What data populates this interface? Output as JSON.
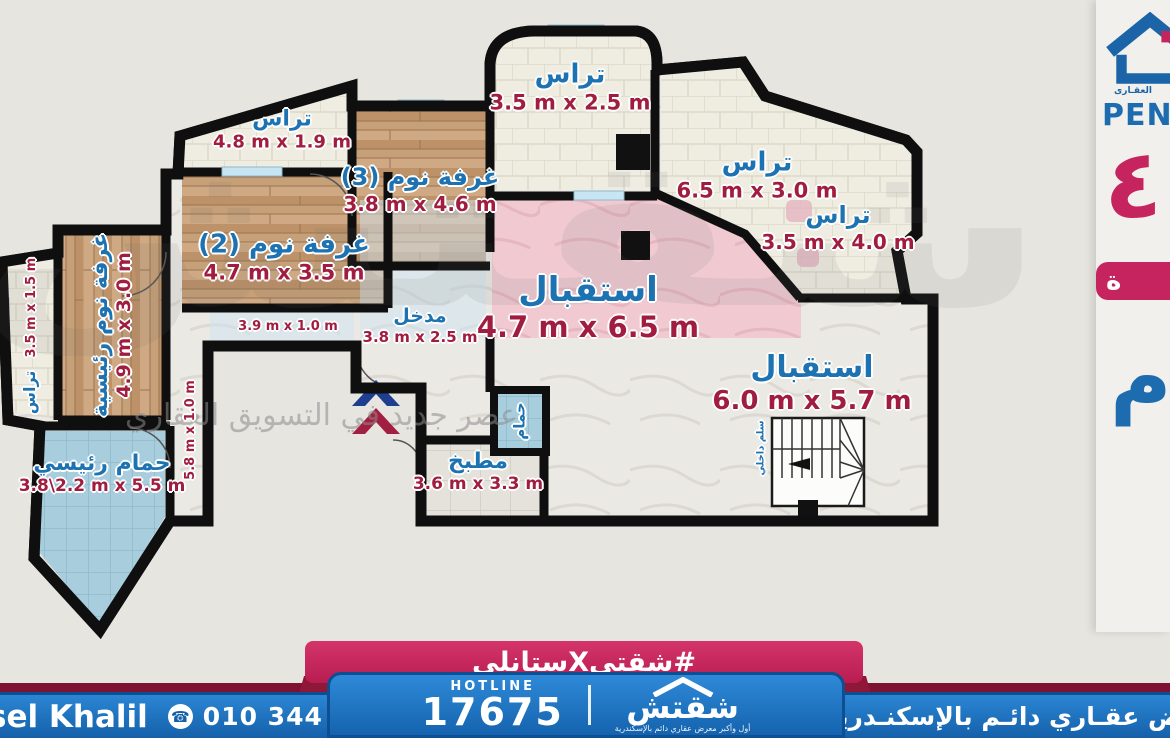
{
  "plan": {
    "terrace_top": {
      "label": "تراس",
      "dims": "3.5 m x 2.5 m"
    },
    "terrace_ne": {
      "label": "تراس",
      "dims": "6.5 m x 3.0 m"
    },
    "terrace_e": {
      "label": "تراس",
      "dims": "3.5 m x 4.0 m"
    },
    "terrace_nw": {
      "label": "تراس",
      "dims": "4.8 m x 1.9 m"
    },
    "terrace_w": {
      "label": "تراس",
      "dims": "3.5 m x 1.5 m"
    },
    "bedroom3": {
      "label": "غرفة نوم (3)",
      "dims": "3.8 m x 4.6 m"
    },
    "bedroom2": {
      "label": "غرفة نوم (2)",
      "dims": "4.7 m x 3.5 m"
    },
    "master_bedroom": {
      "label": "غرفة نوم رئيسية",
      "dims": "4.9 m x 3.0 m"
    },
    "reception_1": {
      "label": "استقبال",
      "dims": "4.7 m x 6.5 m"
    },
    "reception_2": {
      "label": "استقبال",
      "dims": "6.0 m x 5.7 m"
    },
    "entrance": {
      "label": "مدخل",
      "dims": "3.8 m x 2.5 m"
    },
    "bathroom": {
      "label": "حمام"
    },
    "kitchen": {
      "label": "مطبخ",
      "dims": "3.6 m x 3.3 m"
    },
    "master_bathroom": {
      "label": "حمام رئيسي",
      "dims": "3.8\\2.2 m x 5.5 m"
    },
    "corridor_top": {
      "dims": "3.9 m x 1.0 m"
    },
    "corridor_side": {
      "dims": "5.8 m x 1.0 m"
    },
    "stairs": {
      "label": "سلم داخلي"
    }
  },
  "watermark": {
    "brand": "شقتش",
    "tagline": "عصر جديد في التسويق العقاري"
  },
  "side_panel": {
    "logo_caption": "العقـارى",
    "title_partial": "PEN",
    "glyph_pink": "٤",
    "glyph_blue": "م",
    "badge_partial": "ة"
  },
  "footer": {
    "hashtag": "#شقتيXستانلي",
    "hotline_label": "HOTLINE",
    "hotline_number": "17675",
    "brand": "شقتش",
    "brand_subtitle": "أول وأكبر معرض عقاري دائم بالإسكندرية",
    "agent_name_partial": "sel Khalil",
    "phone_icon": "☎",
    "agent_phone": "010 344 838 69",
    "right_bar_partial": "رض عقـاري دائـم بالإسكنـدرية"
  },
  "colors": {
    "label_blue": "#1d72b2",
    "label_red": "#a01d40",
    "banner_blue": "#1565af",
    "ribbon_pink": "#c2275c",
    "maroon": "#7e1233"
  }
}
